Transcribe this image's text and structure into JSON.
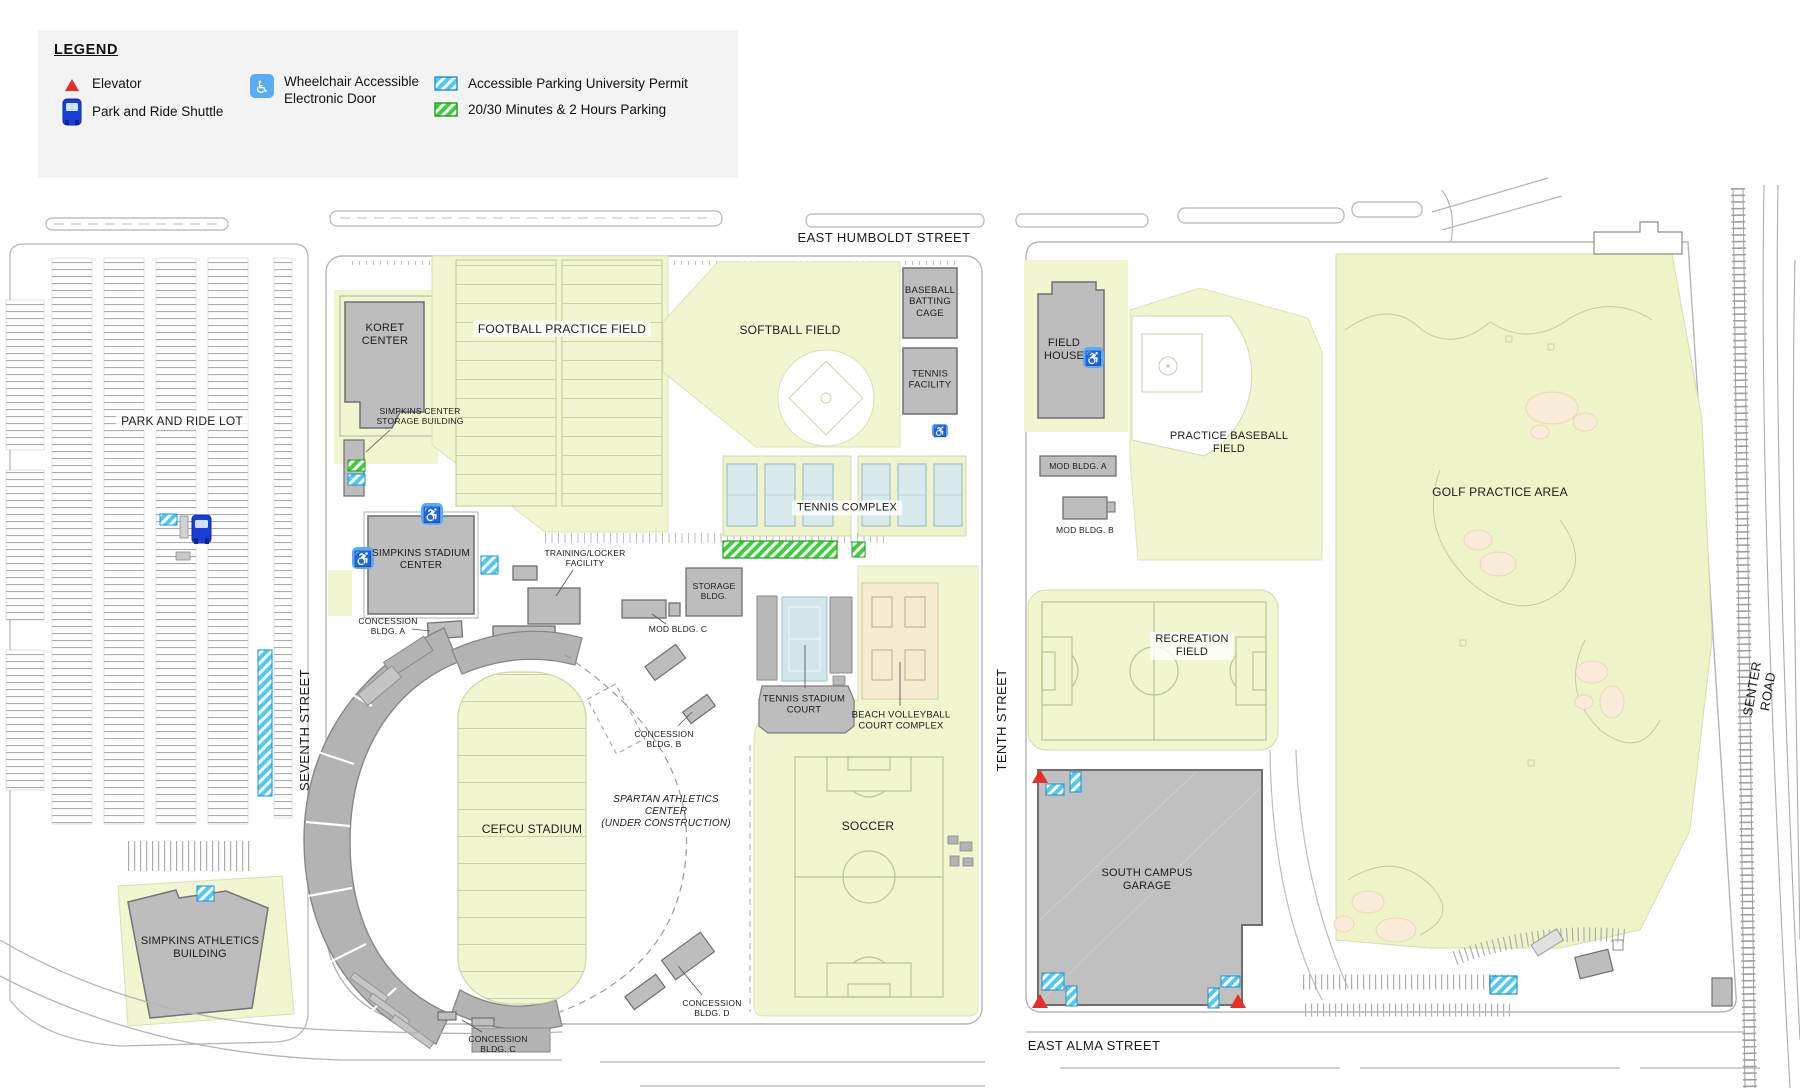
{
  "legend": {
    "title": "LEGEND",
    "items": [
      {
        "label": "Elevator"
      },
      {
        "label": "Park and Ride Shuttle"
      },
      {
        "label": "Wheelchair Accessible\nElectronic Door"
      },
      {
        "label": "Accessible Parking University Permit"
      },
      {
        "label": "20/30 Minutes & 2 Hours Parking"
      }
    ]
  },
  "streets": {
    "east_humboldt": "EAST HUMBOLDT STREET",
    "east_alma": "EAST ALMA STREET",
    "seventh": "SEVENTH STREET",
    "tenth": "TENTH STREET",
    "senter": "SENTER ROAD"
  },
  "labels": {
    "park_and_ride_lot": "PARK AND RIDE LOT",
    "simpkins_athletics_building": "SIMPKINS ATHLETICS\nBUILDING",
    "koret_center": "KORET\nCENTER",
    "simpkins_center_storage_building": "SIMPKINS CENTER\nSTORAGE BUILDING",
    "football_practice_field": "FOOTBALL PRACTICE FIELD",
    "softball_field": "SOFTBALL FIELD",
    "baseball_batting_cage": "BASEBALL\nBATTING\nCAGE",
    "tennis_facility": "TENNIS\nFACILITY",
    "tennis_complex": "TENNIS COMPLEX",
    "simpkins_stadium_center": "SIMPKINS STADIUM\nCENTER",
    "training_locker_facility": "TRAINING/LOCKER\nFACILITY",
    "storage_bldg": "STORAGE\nBLDG.",
    "mod_bldg_a": "MOD BLDG. A",
    "mod_bldg_b": "MOD BLDG. B",
    "mod_bldg_c": "MOD BLDG. C",
    "concession_bldg_a": "CONCESSION\nBLDG. A",
    "concession_bldg_b": "CONCESSION\nBLDG. B",
    "concession_bldg_c": "CONCESSION\nBLDG. C",
    "concession_bldg_d": "CONCESSION\nBLDG. D",
    "cefcu_stadium": "CEFCU STADIUM",
    "spartan_athletics_center": "SPARTAN ATHLETICS\nCENTER\n(UNDER CONSTRUCTION)",
    "tennis_stadium_court": "TENNIS STADIUM\nCOURT",
    "beach_volleyball_court_complex": "BEACH VOLLEYBALL\nCOURT COMPLEX",
    "soccer": "SOCCER",
    "field_house": "FIELD\nHOUSE",
    "practice_baseball_field": "PRACTICE BASEBALL\nFIELD",
    "golf_practice_area": "GOLF PRACTICE AREA",
    "recreation_field": "RECREATION\nFIELD",
    "south_campus_garage": "SOUTH CAMPUS\nGARAGE"
  },
  "colors": {
    "field_green": "#f1f5d0",
    "golf_green": "#eef3c8",
    "sand": "#f6ecd2",
    "building_gray": "#bdbdbd",
    "court_blue": "#d2e7ea",
    "accessible_parking_blue": "#4ec9f2",
    "timed_parking_green": "#3ecf3e",
    "elevator_red": "#e53026",
    "shuttle_blue": "#1b3fd6",
    "legend_bg": "#f3f3f3"
  }
}
